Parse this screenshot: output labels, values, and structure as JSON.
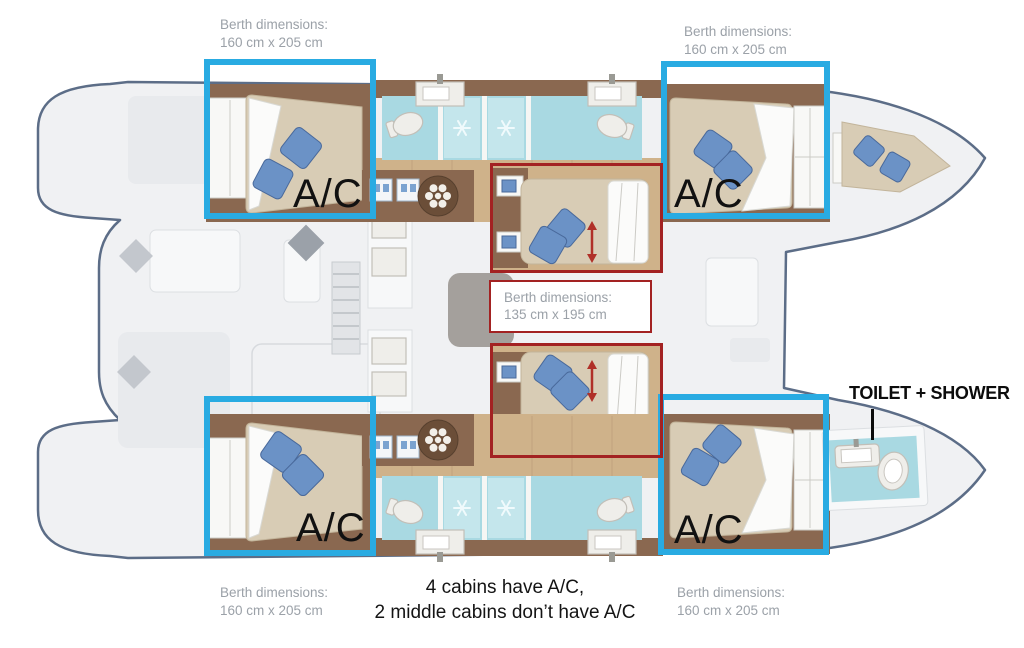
{
  "colors": {
    "highlight_blue": "#29abe2",
    "highlight_red": "#a32222",
    "label_gray": "#9ba1a8",
    "annotation_black": "#111111",
    "hull_outline": "#5c6d87",
    "deck_fill": "#f0f1f3",
    "wood_floor": "#cfb28a",
    "wood_dark": "#8a6850",
    "mattress": "#d8ccb5",
    "pillow_blue": "#6b92c6",
    "bath_aqua": "#a9d9e2",
    "duvet_white": "#fbfbfa",
    "info_box_bg": "#ffffff"
  },
  "annotations": {
    "berth_outer_labels": [
      {
        "line1": "Berth dimensions:",
        "line2": "160 cm x 205 cm"
      },
      {
        "line1": "Berth dimensions:",
        "line2": "160 cm x 205 cm"
      },
      {
        "line1": "Berth dimensions:",
        "line2": "160 cm x 205 cm"
      },
      {
        "line1": "Berth dimensions:",
        "line2": "160 cm x 205 cm"
      }
    ],
    "berth_middle_label": {
      "line1": "Berth dimensions:",
      "line2": "135 cm x 195 cm"
    },
    "ac_labels": [
      "A/C",
      "A/C",
      "A/C",
      "A/C"
    ],
    "toilet_shower_label": "TOILET + SHOWER",
    "caption_line1": "4 cabins have A/C,",
    "caption_line2": "2 middle cabins don’t have A/C"
  }
}
